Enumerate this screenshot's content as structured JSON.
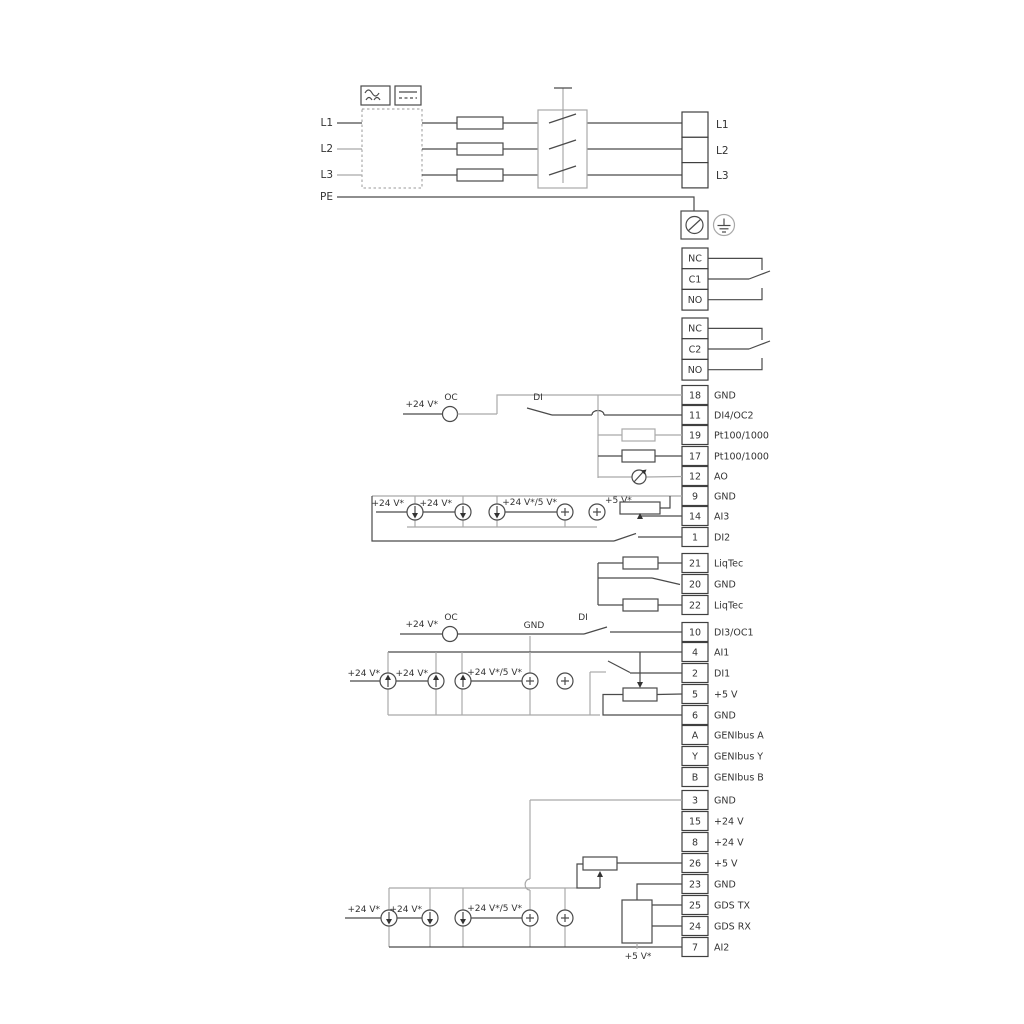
{
  "colors": {
    "wire": "#4a4a4a",
    "wire_alt": "#a9a9a9",
    "text": "#333333",
    "background": "#ffffff"
  },
  "power_in": [
    "L1",
    "L2",
    "L3",
    "PE"
  ],
  "power_out": [
    "L1",
    "L2",
    "L3"
  ],
  "relay1": [
    "NC",
    "C1",
    "NO"
  ],
  "relay2": [
    "NC",
    "C2",
    "NO"
  ],
  "strip1": [
    {
      "n": "18",
      "l": "GND"
    },
    {
      "n": "11",
      "l": "DI4/OC2"
    },
    {
      "n": "19",
      "l": "Pt100/1000"
    },
    {
      "n": "17",
      "l": "Pt100/1000"
    },
    {
      "n": "12",
      "l": "AO"
    },
    {
      "n": "9",
      "l": "GND"
    },
    {
      "n": "14",
      "l": "AI3"
    },
    {
      "n": "1",
      "l": "DI2"
    }
  ],
  "liqtec": [
    {
      "n": "21",
      "l": "LiqTec"
    },
    {
      "n": "20",
      "l": "GND"
    },
    {
      "n": "22",
      "l": "LiqTec"
    }
  ],
  "t10": {
    "n": "10",
    "l": "DI3/OC1"
  },
  "strip2": [
    {
      "n": "4",
      "l": "AI1"
    },
    {
      "n": "2",
      "l": "DI1"
    },
    {
      "n": "5",
      "l": "+5 V"
    },
    {
      "n": "6",
      "l": "GND"
    },
    {
      "n": "A",
      "l": "GENIbus A"
    },
    {
      "n": "Y",
      "l": "GENIbus Y"
    },
    {
      "n": "B",
      "l": "GENIbus B"
    }
  ],
  "strip3": [
    {
      "n": "3",
      "l": "GND"
    },
    {
      "n": "15",
      "l": "+24 V"
    },
    {
      "n": "8",
      "l": "+24 V"
    },
    {
      "n": "26",
      "l": "+5 V"
    },
    {
      "n": "23",
      "l": "GND"
    },
    {
      "n": "25",
      "l": "GDS TX"
    },
    {
      "n": "24",
      "l": "GDS RX"
    },
    {
      "n": "7",
      "l": "AI2"
    }
  ],
  "ann": {
    "v24": "+24 V*",
    "oc": "OC",
    "di": "DI",
    "gnd": "GND",
    "v24_5": "+24 V*/5 V*",
    "v5": "+5 V*"
  }
}
